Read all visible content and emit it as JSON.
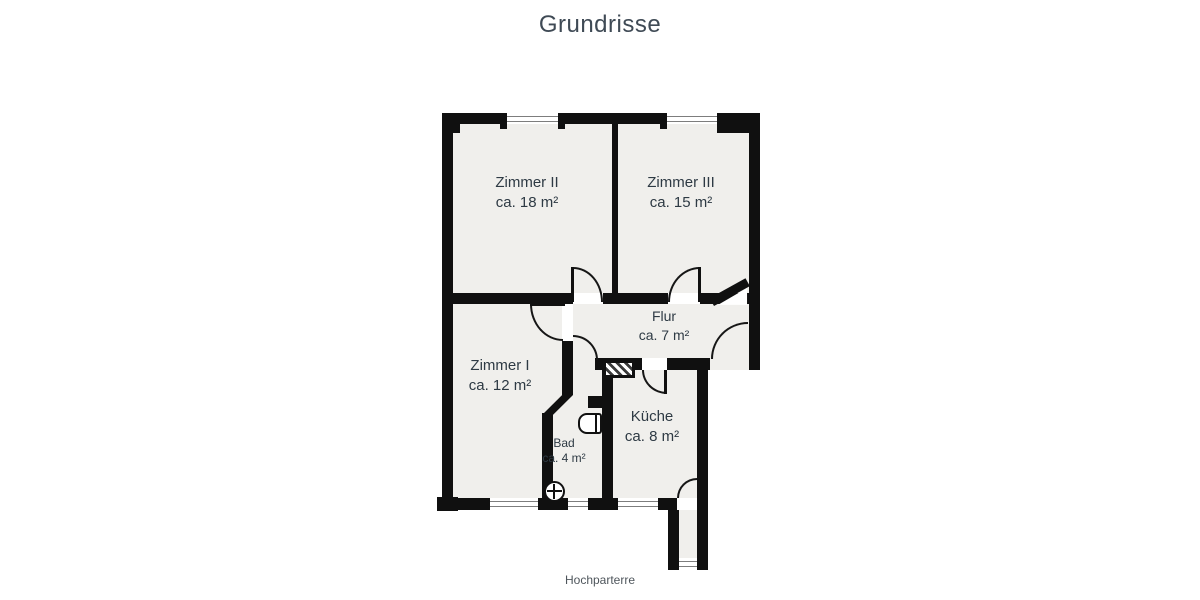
{
  "title": "Grundrisse",
  "caption": "Hochparterre",
  "rooms": [
    {
      "id": "zimmer2",
      "label": "Zimmer II",
      "area": "ca. 18 m²"
    },
    {
      "id": "zimmer3",
      "label": "Zimmer III",
      "area": "ca. 15 m²"
    },
    {
      "id": "zimmer1",
      "label": "Zimmer I",
      "area": "ca. 12 m²"
    },
    {
      "id": "flur",
      "label": "Flur",
      "area": "ca. 7 m²"
    },
    {
      "id": "kueche",
      "label": "Küche",
      "area": "ca. 8 m²"
    },
    {
      "id": "bad",
      "label": "Bad",
      "area": "ca. 4 m²"
    }
  ],
  "colors": {
    "wall": "#101010",
    "floor": "#f0efec",
    "title_text": "#3f4a55",
    "label_text": "#2e3a44",
    "caption_text": "#4f565c"
  }
}
